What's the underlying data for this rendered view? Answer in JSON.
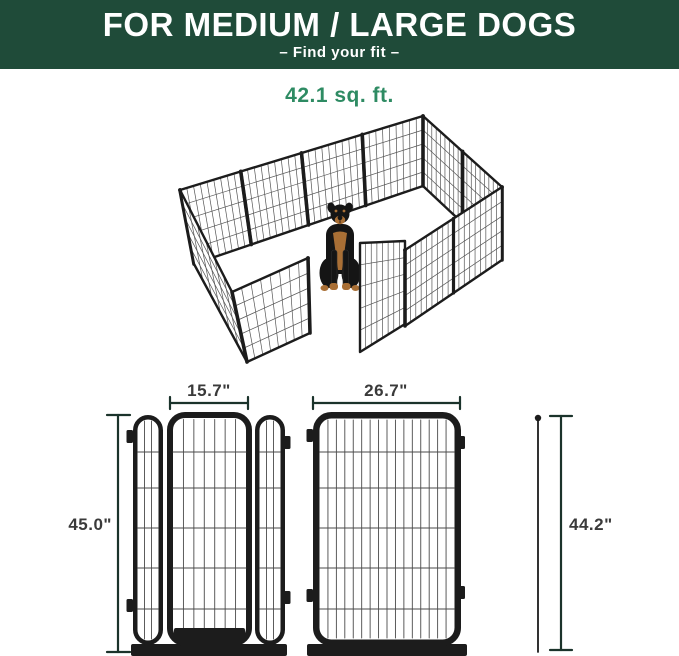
{
  "header": {
    "title": "FOR MEDIUM / LARGE DOGS",
    "subtitle": "–  Find your fit  –"
  },
  "area_label": "42.1 sq. ft.",
  "illustration": {
    "subject": "12-panel metal dog playpen with open gate and sitting rottweiler",
    "view": "isometric"
  },
  "diagrams": {
    "door_panel": {
      "door_width": "15.7\"",
      "panel_height": "45.0\""
    },
    "regular_panel": {
      "panel_width": "26.7\"",
      "panel_height": "44.2\""
    }
  },
  "colors": {
    "header_bg": "#1f4b39",
    "accent_green": "#2e8b63",
    "dimension": "#1b332b",
    "frame": "#1c1c1c",
    "wire": "#555555",
    "dog_black": "#151515",
    "dog_tan": "#a96f35"
  }
}
